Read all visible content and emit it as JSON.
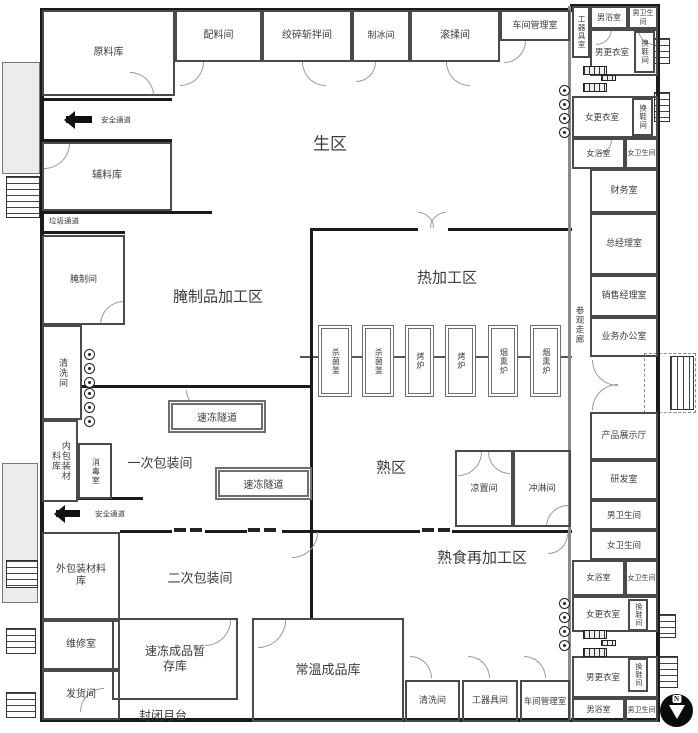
{
  "plan": {
    "colors": {
      "wall": "#1b1b1b",
      "partition": "#8a8a8a",
      "platform": "#ececec",
      "text": "#3c3c3c"
    },
    "compass": {
      "label": "N"
    },
    "walls": [
      [
        40,
        8,
        534,
        4
      ],
      [
        570,
        4,
        90,
        4
      ],
      [
        40,
        8,
        4,
        714
      ],
      [
        40,
        718,
        620,
        4
      ],
      [
        656,
        4,
        4,
        718
      ],
      [
        310,
        228,
        108,
        3
      ],
      [
        448,
        228,
        124,
        3
      ],
      [
        310,
        228,
        3,
        190
      ],
      [
        310,
        415,
        3,
        118
      ],
      [
        120,
        530,
        52,
        3
      ],
      [
        205,
        530,
        42,
        3
      ],
      [
        282,
        530,
        138,
        3
      ],
      [
        452,
        530,
        120,
        3
      ],
      [
        310,
        532,
        3,
        88
      ],
      [
        82,
        385,
        228,
        3
      ],
      [
        42,
        98,
        130,
        3
      ],
      [
        42,
        139,
        130,
        3
      ],
      [
        42,
        211,
        170,
        3
      ],
      [
        42,
        231,
        83,
        3
      ],
      [
        77,
        497,
        66,
        3
      ]
    ],
    "gray_walls": [
      [
        568,
        6,
        3,
        714
      ]
    ],
    "equip_line": [
      300,
      356,
      272,
      2
    ],
    "rooms": [
      {
        "id": "raw-material-warehouse",
        "label": "原料库",
        "x": 42,
        "y": 10,
        "w": 133,
        "h": 86,
        "fs": 10
      },
      {
        "id": "ingredient-room",
        "label": "配料间",
        "x": 175,
        "y": 10,
        "w": 87,
        "h": 52,
        "fs": 10
      },
      {
        "id": "grinding-chopping-room",
        "label": "绞碎斩拌间",
        "x": 262,
        "y": 10,
        "w": 90,
        "h": 52,
        "fs": 10
      },
      {
        "id": "ice-making-room",
        "label": "制冰间",
        "x": 352,
        "y": 10,
        "w": 58,
        "h": 52,
        "fs": 9
      },
      {
        "id": "tumbling-room",
        "label": "滚揉间",
        "x": 410,
        "y": 10,
        "w": 90,
        "h": 52,
        "fs": 10
      },
      {
        "id": "workshop-office-top",
        "label": "车间管理室",
        "x": 500,
        "y": 10,
        "w": 70,
        "h": 31,
        "fs": 9
      },
      {
        "id": "tool-room-top",
        "label": "工器具室",
        "x": 572,
        "y": 6,
        "w": 18,
        "h": 52,
        "fs": 7.5,
        "vertical": true
      },
      {
        "id": "mens-bath-top",
        "label": "男浴室",
        "x": 590,
        "y": 6,
        "w": 38,
        "h": 23,
        "fs": 8
      },
      {
        "id": "mens-toilet-top",
        "label": "男卫生间",
        "x": 628,
        "y": 6,
        "w": 30,
        "h": 23,
        "fs": 7
      },
      {
        "id": "mens-locker-top",
        "label": "男更衣室",
        "x": 590,
        "y": 29,
        "w": 68,
        "h": 47,
        "fs": 8.5,
        "padRight": 24
      },
      {
        "id": "shoe-change-room-top-m",
        "label": "换鞋间",
        "x": 634,
        "y": 31,
        "w": 21,
        "h": 42,
        "fs": 7.5,
        "vertical": true
      },
      {
        "id": "womens-locker-top",
        "label": "女更衣室",
        "x": 572,
        "y": 96,
        "w": 86,
        "h": 42,
        "fs": 8.5,
        "padRight": 26
      },
      {
        "id": "shoe-change-room-top-f",
        "label": "换鞋间",
        "x": 632,
        "y": 98,
        "w": 21,
        "h": 38,
        "fs": 7.5,
        "vertical": true
      },
      {
        "id": "womens-bath-top",
        "label": "女浴室",
        "x": 572,
        "y": 138,
        "w": 53,
        "h": 31,
        "fs": 8
      },
      {
        "id": "womens-toilet-top",
        "label": "女卫生间",
        "x": 625,
        "y": 138,
        "w": 33,
        "h": 31,
        "fs": 7
      },
      {
        "id": "finance-office",
        "label": "财务室",
        "x": 590,
        "y": 169,
        "w": 68,
        "h": 44,
        "fs": 9
      },
      {
        "id": "general-manager-office",
        "label": "总经理室",
        "x": 590,
        "y": 213,
        "w": 68,
        "h": 62,
        "fs": 9
      },
      {
        "id": "sales-manager-office",
        "label": "销售经理室",
        "x": 590,
        "y": 275,
        "w": 68,
        "h": 42,
        "fs": 9
      },
      {
        "id": "business-office",
        "label": "业务办公室",
        "x": 590,
        "y": 317,
        "w": 68,
        "h": 40,
        "fs": 9
      },
      {
        "id": "product-showroom",
        "label": "产品展示厅",
        "x": 590,
        "y": 412,
        "w": 68,
        "h": 48,
        "fs": 9
      },
      {
        "id": "rd-room",
        "label": "研发室",
        "x": 590,
        "y": 460,
        "w": 68,
        "h": 40,
        "fs": 9
      },
      {
        "id": "mens-toilet-mid",
        "label": "男卫生间",
        "x": 590,
        "y": 500,
        "w": 68,
        "h": 30,
        "fs": 8.5
      },
      {
        "id": "womens-toilet-mid",
        "label": "女卫生间",
        "x": 590,
        "y": 530,
        "w": 68,
        "h": 30,
        "fs": 8.5
      },
      {
        "id": "womens-bath-bottom",
        "label": "女浴室",
        "x": 572,
        "y": 560,
        "w": 53,
        "h": 36,
        "fs": 8
      },
      {
        "id": "womens-toilet-bottom",
        "label": "女卫生间",
        "x": 625,
        "y": 560,
        "w": 33,
        "h": 36,
        "fs": 7
      },
      {
        "id": "womens-locker-bottom",
        "label": "女更衣室",
        "x": 572,
        "y": 596,
        "w": 86,
        "h": 36,
        "fs": 8.5,
        "padRight": 24
      },
      {
        "id": "shoe-change-room-bottom-f",
        "label": "换鞋间",
        "x": 628,
        "y": 599,
        "w": 20,
        "h": 32,
        "fs": 7,
        "vertical": true
      },
      {
        "id": "mens-locker-bottom",
        "label": "男更衣室",
        "x": 572,
        "y": 656,
        "w": 86,
        "h": 42,
        "fs": 8.5,
        "padRight": 24
      },
      {
        "id": "shoe-change-room-bottom-m",
        "label": "换鞋间",
        "x": 628,
        "y": 658,
        "w": 20,
        "h": 34,
        "fs": 7,
        "vertical": true
      },
      {
        "id": "mens-bath-bottom",
        "label": "男浴室",
        "x": 572,
        "y": 698,
        "w": 53,
        "h": 24,
        "fs": 8
      },
      {
        "id": "mens-toilet-bottom",
        "label": "男卫生间",
        "x": 625,
        "y": 698,
        "w": 33,
        "h": 24,
        "fs": 7
      },
      {
        "id": "aux-material-warehouse",
        "label": "辅料库",
        "x": 42,
        "y": 142,
        "w": 130,
        "h": 69,
        "fs": 10
      },
      {
        "id": "curing-room",
        "label": "腌制间",
        "x": 42,
        "y": 235,
        "w": 83,
        "h": 90,
        "fs": 9
      },
      {
        "id": "washing-room-left",
        "label": "清洗间",
        "x": 42,
        "y": 325,
        "w": 40,
        "h": 95,
        "fs": 9,
        "vertical": true
      },
      {
        "id": "inner-packing-material-warehouse",
        "label": "内包装材料库",
        "x": 42,
        "y": 420,
        "w": 36,
        "h": 82,
        "fs": 9,
        "vertical": true,
        "lh": 48
      },
      {
        "id": "disinfection-room",
        "label": "消毒室",
        "x": 78,
        "y": 443,
        "w": 34,
        "h": 56,
        "fs": 8,
        "vertical": true
      },
      {
        "id": "outer-packing-material-warehouse",
        "label": "外包装材料库",
        "x": 42,
        "y": 532,
        "w": 78,
        "h": 88,
        "fs": 10,
        "maxw": 58
      },
      {
        "id": "maintenance-room",
        "label": "维修室",
        "x": 42,
        "y": 620,
        "w": 78,
        "h": 50,
        "fs": 10
      },
      {
        "id": "shipping-room",
        "label": "发货间",
        "x": 42,
        "y": 670,
        "w": 78,
        "h": 50,
        "fs": 10
      },
      {
        "id": "frozen-product-temp-storage",
        "label": "速冻成品暂存库",
        "x": 112,
        "y": 618,
        "w": 126,
        "h": 82,
        "fs": 12,
        "maxw": 70
      },
      {
        "id": "ambient-product-warehouse",
        "label": "常温成品库",
        "x": 252,
        "y": 618,
        "w": 152,
        "h": 104,
        "fs": 13
      },
      {
        "id": "washing-room-bottom",
        "label": "清洗间",
        "x": 405,
        "y": 680,
        "w": 55,
        "h": 42,
        "fs": 9
      },
      {
        "id": "tool-room-bottom",
        "label": "工器具间",
        "x": 462,
        "y": 680,
        "w": 56,
        "h": 42,
        "fs": 9
      },
      {
        "id": "workshop-office-bottom",
        "label": "车间管理室",
        "x": 520,
        "y": 680,
        "w": 50,
        "h": 42,
        "fs": 8.5
      },
      {
        "id": "cooling-room",
        "label": "凉置间",
        "x": 455,
        "y": 450,
        "w": 58,
        "h": 77,
        "fs": 9
      },
      {
        "id": "shower-room",
        "label": "冲淋间",
        "x": 513,
        "y": 450,
        "w": 58,
        "h": 77,
        "fs": 9
      }
    ],
    "tunnels": [
      {
        "id": "freeze-tunnel-1",
        "label": "速冻隧道",
        "x": 168,
        "y": 400,
        "w": 98,
        "h": 33,
        "fs": 10
      },
      {
        "id": "freeze-tunnel-2",
        "label": "速冻隧道",
        "x": 215,
        "y": 467,
        "w": 97,
        "h": 33,
        "fs": 10
      }
    ],
    "equipment": [
      {
        "id": "sterilizer-1",
        "label": "杀菌釜",
        "x": 318,
        "y": 325,
        "w": 34,
        "h": 72,
        "fs": 8
      },
      {
        "id": "sterilizer-2",
        "label": "杀菌釜",
        "x": 362,
        "y": 325,
        "w": 32,
        "h": 72,
        "fs": 8
      },
      {
        "id": "oven-1",
        "label": "烤炉",
        "x": 405,
        "y": 325,
        "w": 29,
        "h": 72,
        "fs": 8
      },
      {
        "id": "oven-2",
        "label": "烤炉",
        "x": 445,
        "y": 325,
        "w": 31,
        "h": 72,
        "fs": 8
      },
      {
        "id": "smoker-1",
        "label": "烟熏炉",
        "x": 488,
        "y": 325,
        "w": 30,
        "h": 72,
        "fs": 8
      },
      {
        "id": "smoker-2",
        "label": "烟熏炉",
        "x": 530,
        "y": 325,
        "w": 31,
        "h": 72,
        "fs": 8
      }
    ],
    "zone_labels": [
      {
        "id": "zone-raw-area",
        "label": "生区",
        "x": 330,
        "y": 142,
        "fs": 17
      },
      {
        "id": "zone-hot-processing",
        "label": "热加工区",
        "x": 447,
        "y": 277,
        "fs": 15
      },
      {
        "id": "zone-cured-processing",
        "label": "腌制品加工区",
        "x": 218,
        "y": 296,
        "fs": 15
      },
      {
        "id": "zone-cooked-area",
        "label": "熟区",
        "x": 391,
        "y": 467,
        "fs": 15
      },
      {
        "id": "zone-cooked-reprocessing",
        "label": "熟食再加工区",
        "x": 482,
        "y": 557,
        "fs": 15
      },
      {
        "id": "zone-primary-packing",
        "label": "一次包装间",
        "x": 160,
        "y": 462,
        "fs": 13
      },
      {
        "id": "zone-secondary-packing",
        "label": "二次包装间",
        "x": 200,
        "y": 577,
        "fs": 13
      },
      {
        "id": "closed-dock",
        "label": "封闭月台",
        "x": 163,
        "y": 715,
        "fs": 12
      },
      {
        "id": "visit-corridor",
        "label": "参观走廊",
        "x": 580,
        "y": 325,
        "fs": 8.5,
        "vertical": true
      },
      {
        "id": "garbage-passage",
        "label": "垃圾通道",
        "x": 64,
        "y": 221,
        "fs": 7.5
      },
      {
        "id": "safety-passage-top-label",
        "label": "安全通道",
        "x": 116,
        "y": 120,
        "fs": 7.5
      },
      {
        "id": "safety-passage-mid-label",
        "label": "安全通道",
        "x": 110,
        "y": 514,
        "fs": 7.5
      }
    ],
    "arrows": [
      {
        "id": "safety-arrow-top",
        "x": 66,
        "y": 116,
        "len": 26
      },
      {
        "id": "safety-arrow-mid",
        "x": 56,
        "y": 510,
        "len": 24
      }
    ],
    "doors": [
      [
        180,
        62,
        24,
        0
      ],
      [
        302,
        62,
        24,
        90
      ],
      [
        356,
        62,
        20,
        0
      ],
      [
        446,
        62,
        24,
        90
      ],
      [
        130,
        72,
        24,
        270
      ],
      [
        504,
        41,
        22,
        0
      ],
      [
        418,
        212,
        16,
        270
      ],
      [
        430,
        212,
        16,
        180
      ],
      [
        100,
        301,
        24,
        180
      ],
      [
        44,
        143,
        26,
        0
      ],
      [
        186,
        390,
        20,
        90
      ],
      [
        292,
        532,
        26,
        0
      ],
      [
        548,
        534,
        20,
        0
      ],
      [
        592,
        360,
        26,
        90
      ],
      [
        592,
        384,
        26,
        180
      ],
      [
        458,
        452,
        24,
        0
      ],
      [
        488,
        452,
        22,
        90
      ],
      [
        546,
        505,
        22,
        180
      ],
      [
        258,
        620,
        28,
        0
      ],
      [
        205,
        620,
        26,
        0
      ],
      [
        410,
        656,
        22,
        270
      ],
      [
        468,
        656,
        22,
        270
      ],
      [
        524,
        656,
        22,
        270
      ],
      [
        80,
        688,
        24,
        180
      ],
      [
        596,
        29,
        16,
        0
      ],
      [
        638,
        29,
        16,
        90
      ],
      [
        598,
        140,
        14,
        0
      ]
    ],
    "slide_ticks": [
      [
        174,
        528,
        12,
        4
      ],
      [
        190,
        528,
        12,
        4
      ],
      [
        248,
        528,
        12,
        4
      ],
      [
        264,
        528,
        12,
        4
      ],
      [
        422,
        528,
        12,
        4
      ],
      [
        438,
        528,
        12,
        4
      ]
    ],
    "stairs": [
      {
        "x": 6,
        "y": 176,
        "w": 34,
        "h": 42,
        "dir": "v"
      },
      {
        "x": 6,
        "y": 560,
        "w": 32,
        "h": 28,
        "dir": "v"
      },
      {
        "x": 6,
        "y": 628,
        "w": 30,
        "h": 26,
        "dir": "v"
      },
      {
        "x": 6,
        "y": 692,
        "w": 30,
        "h": 26,
        "dir": "v"
      },
      {
        "x": 654,
        "y": 38,
        "w": 16,
        "h": 26,
        "dir": "v"
      },
      {
        "x": 654,
        "y": 92,
        "w": 16,
        "h": 30,
        "dir": "v"
      },
      {
        "x": 670,
        "y": 356,
        "w": 24,
        "h": 54,
        "dir": "h"
      },
      {
        "x": 656,
        "y": 614,
        "w": 20,
        "h": 24,
        "dir": "v"
      },
      {
        "x": 658,
        "y": 656,
        "w": 20,
        "h": 32,
        "dir": "v"
      }
    ],
    "platforms": [
      {
        "x": 2,
        "y": 62,
        "w": 38,
        "h": 112
      },
      {
        "x": 2,
        "y": 463,
        "w": 36,
        "h": 140
      }
    ],
    "dashed_boxes": [
      [
        644,
        353,
        52,
        60
      ]
    ],
    "handwash_stations": [
      {
        "x": 84,
        "y": 349,
        "n": 3
      },
      {
        "x": 84,
        "y": 388,
        "n": 3
      },
      {
        "x": 559,
        "y": 85,
        "n": 4
      },
      {
        "x": 559,
        "y": 598,
        "n": 4
      }
    ],
    "lockers": [
      [
        583,
        66,
        22,
        7
      ],
      [
        583,
        83,
        22,
        7
      ],
      [
        601,
        75,
        13,
        4
      ],
      [
        583,
        630,
        22,
        7
      ],
      [
        583,
        648,
        22,
        7
      ],
      [
        601,
        640,
        13,
        4
      ]
    ]
  }
}
